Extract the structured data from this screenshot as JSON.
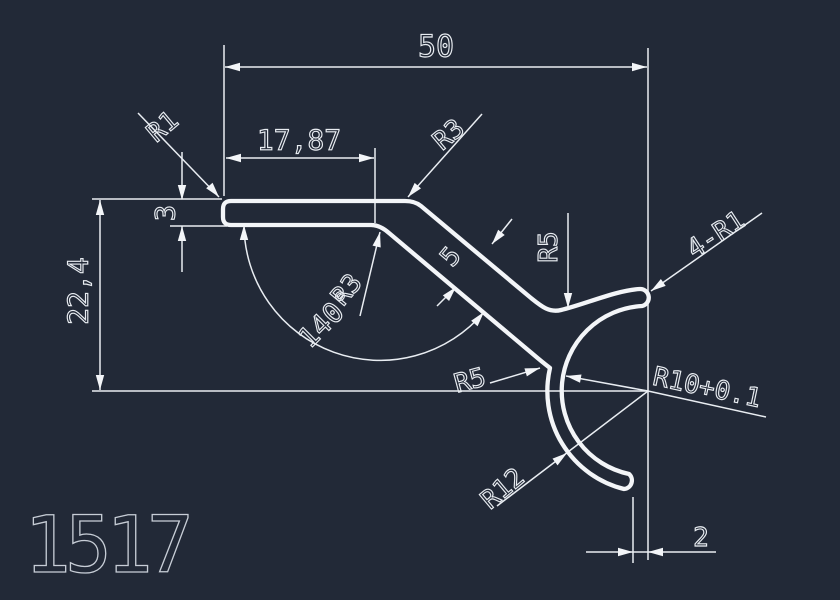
{
  "page": {
    "background_color": "#222937",
    "line_color": "#f3f5f8",
    "text_color": "#e8ecf1"
  },
  "drawing": {
    "profile_number": "1517",
    "dimensions": {
      "overall_width": "50",
      "top_flat_length": "17,87",
      "top_thickness": "3",
      "overall_height": "22,4",
      "bend_angle": "140°",
      "strip_thickness": "5",
      "tip_offset": "2"
    },
    "radii": {
      "corner_top_left": "R1",
      "corner_top": "R3",
      "corner_bottom": "R3",
      "fillet_valley": "R5",
      "fillet_crotch": "R5",
      "hook_inner": "R10+0.1",
      "hook_outer": "R12",
      "tip_corners": "4-R1"
    }
  }
}
